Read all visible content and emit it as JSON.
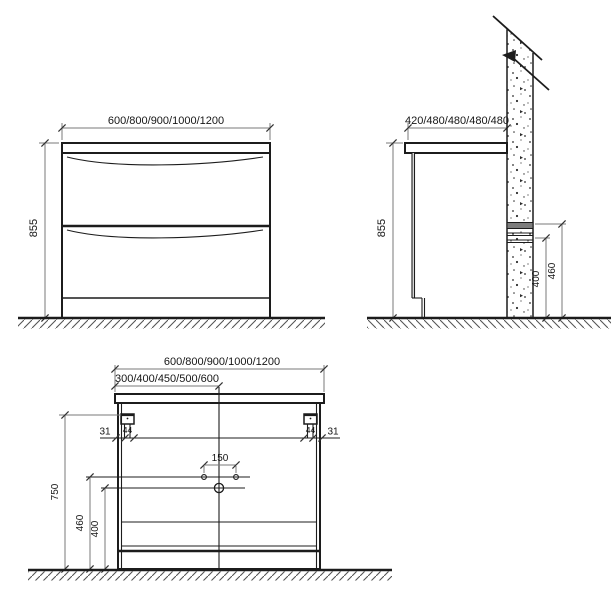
{
  "drawing": {
    "type": "vanity-cabinet-dimension-drawing",
    "front_view": {
      "width_options_label": "600/800/900/1000/1200",
      "height_label": "855"
    },
    "side_view": {
      "depth_options_label": "420/480/480/480/480",
      "height_label": "855",
      "upper_fixing_height_label": "460",
      "lower_fixing_height_label": "400"
    },
    "back_view": {
      "width_options_label": "600/800/900/1000/1200",
      "half_width_options_label": "300/400/450/500/600",
      "hanger_offset_left_label": "31",
      "hanger_offset_right_label": "31",
      "hanger_width_left_label": "44",
      "hanger_width_right_label": "44",
      "faucet_hole_spacing_label": "150",
      "top_height_label": "750",
      "upper_hole_height_label": "460",
      "lower_hole_height_label": "400"
    },
    "colors": {
      "background": "#ffffff",
      "object_line": "#1c1c1c",
      "dimension_line": "#7a7a7a",
      "wall_rail_fill": "#7d7d7d"
    }
  }
}
